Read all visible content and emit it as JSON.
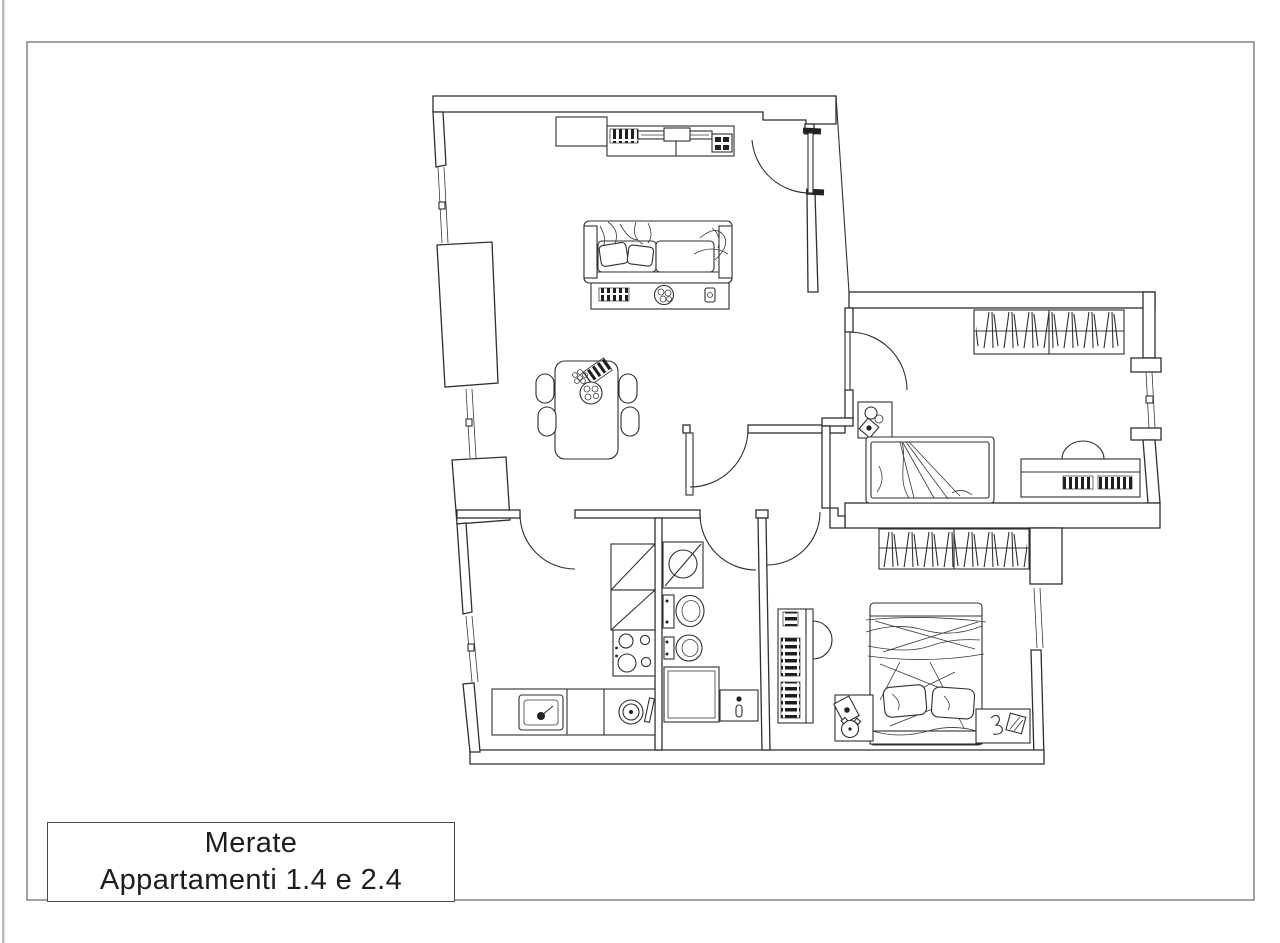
{
  "page": {
    "background": "#ffffff",
    "border_color": "#707070",
    "scan_edge_color": "#9a9a9a",
    "ink_color": "#2f2f2f"
  },
  "title_block": {
    "line1": "Merate",
    "line2": "Appartamenti 1.4 e 2.4"
  },
  "plan": {
    "type": "apartment-floor-plan",
    "symbols": [
      "entrance-door-swing",
      "interior-door-swing",
      "window",
      "wall-pier",
      "sofa",
      "throw-pillows",
      "coffee-table",
      "books",
      "fruit-bowl",
      "tv-console",
      "media-cabinet",
      "dining-table",
      "dining-chair",
      "serving-tray",
      "grapes",
      "wardrobe-hanging-clothes",
      "single-bed",
      "double-bed",
      "pillow",
      "bedside-table",
      "table-lamp",
      "alarm-clock",
      "desk",
      "desk-chair",
      "bookshelf",
      "kitchen-tall-unit",
      "cooktop",
      "kitchen-counter",
      "kitchen-sink",
      "washing-machine",
      "washbasin",
      "toilet",
      "bidet",
      "shower",
      "water-heater"
    ]
  }
}
